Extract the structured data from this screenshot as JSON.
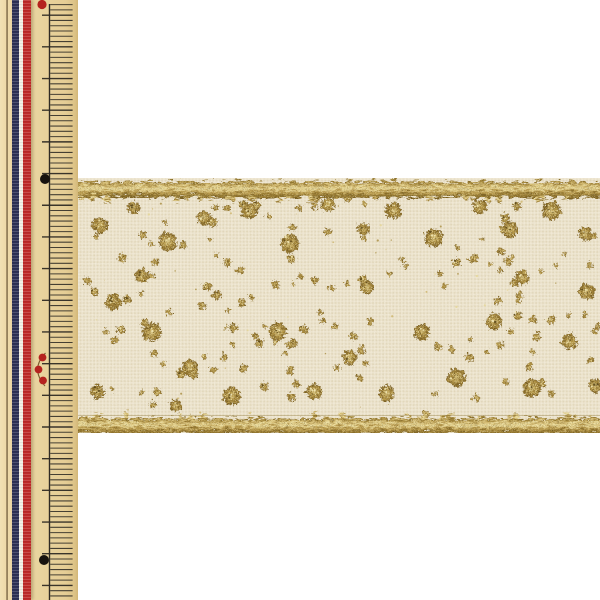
{
  "scene": {
    "description": "Product photo: ivory linen-texture ribbon with gold glitter dot pattern and gold tinsel edges, laid horizontally beside a vertical cream Japanese measuring ruler with a navy/white/red striped trim on its left edge",
    "background": "#ffffff"
  },
  "ruler": {
    "width": 78,
    "body_color": "#e9d5a0",
    "tick_color": "#2f2b24",
    "spine_x": 49.5,
    "spine_top": 4,
    "first_tick_y": 4.6,
    "minor_spacing": 5.28,
    "minors_per_major": 6,
    "major_phase": 2,
    "minor_x1": 50.2,
    "minor_x2": 72.6,
    "major_x1": 42,
    "major_x2": 72.6,
    "markers": {
      "red_dot_top": {
        "x": 42,
        "y": 4.5,
        "r": 4.6,
        "color": "#b5231f"
      },
      "black_dot_upper": {
        "x": 45,
        "y": 179,
        "r": 5,
        "color": "#17130f"
      },
      "black_dot_lower": {
        "x": 44,
        "y": 560,
        "r": 5,
        "color": "#17130f"
      },
      "red_cluster": {
        "color": "#b5231f",
        "r": 3.9,
        "dots": [
          [
            42.5,
            357.5
          ],
          [
            38.5,
            369.5
          ],
          [
            43,
            380.5
          ]
        ],
        "bracket_path": "M 45.5 353 Q 30 369 45 386",
        "bracket_color": "#7c5c30"
      }
    }
  },
  "tricolor": {
    "stripes": [
      {
        "name": "navy",
        "width": 7,
        "color": "#2c3156"
      },
      {
        "name": "white",
        "width": 4,
        "color": "#f3efe3"
      },
      {
        "name": "red",
        "width": 8,
        "color": "#bf2b28"
      }
    ]
  },
  "ribbon": {
    "x": 78,
    "y": 178,
    "width": 522,
    "height": 255,
    "fabric_base": "#efe6d2",
    "weave_light": "#f8f2e1",
    "weave_mid": "#f1ead6",
    "weave_dark": "#e3d8ba",
    "grain_color": [
      0.55,
      0.47,
      0.3
    ],
    "trim_height": 15.5,
    "trim_gradient": [
      "#8d7129",
      "#cdb268",
      "#eee1a4",
      "#c5a85c",
      "#9a7c33",
      "#7c6223"
    ],
    "trim_seam_color": "#8a7030",
    "dot_gold_center": "#dcca8a",
    "dot_gold_mid": "#b3964a",
    "dot_gold_edge": "#7b6126",
    "sparkle_light": "#f1e6b4",
    "sparkle_dark": "#5e4a1b"
  },
  "pattern": {
    "seed": 20231215,
    "big_dots": [
      [
        20,
        46,
        8
      ],
      [
        54,
        28,
        6
      ],
      [
        88,
        62,
        9
      ],
      [
        124,
        38,
        7
      ],
      [
        170,
        31,
        8
      ],
      [
        210,
        64,
        9
      ],
      [
        248,
        25,
        7
      ],
      [
        284,
        49,
        6
      ],
      [
        314,
        31,
        8
      ],
      [
        354,
        58,
        9
      ],
      [
        400,
        27,
        7
      ],
      [
        430,
        50,
        8
      ],
      [
        472,
        31,
        9
      ],
      [
        506,
        54,
        7
      ],
      [
        34,
        122,
        8
      ],
      [
        62,
        96,
        7
      ],
      [
        72,
        152,
        9
      ],
      [
        110,
        188,
        8
      ],
      [
        152,
        216,
        9
      ],
      [
        198,
        152,
        9
      ],
      [
        234,
        212,
        8
      ],
      [
        270,
        178,
        7
      ],
      [
        307,
        214,
        8
      ],
      [
        342,
        152,
        8
      ],
      [
        377,
        198,
        9
      ],
      [
        414,
        142,
        8
      ],
      [
        452,
        208,
        9
      ],
      [
        490,
        162,
        8
      ],
      [
        516,
        206,
        7
      ],
      [
        18,
        212,
        7
      ],
      [
        96,
        226,
        6
      ],
      [
        287,
        107,
        7
      ],
      [
        507,
        112,
        8
      ],
      [
        442,
        98,
        7
      ]
    ],
    "arcs": [
      {
        "cx": 110,
        "cy": 150,
        "r": 45,
        "a0": -70,
        "a1": 190,
        "n": 13
      },
      {
        "cx": 255,
        "cy": 62,
        "r": 46,
        "a0": 50,
        "a1": 310,
        "n": 13
      },
      {
        "cx": 245,
        "cy": 182,
        "r": 38,
        "a0": 140,
        "a1": 390,
        "n": 11
      },
      {
        "cx": 392,
        "cy": 128,
        "r": 48,
        "a0": -130,
        "a1": 115,
        "n": 13
      },
      {
        "cx": 492,
        "cy": 178,
        "r": 42,
        "a0": 115,
        "a1": 335,
        "n": 10
      },
      {
        "cx": 38,
        "cy": 82,
        "r": 38,
        "a0": -50,
        "a1": 150,
        "n": 9
      },
      {
        "cx": 165,
        "cy": 58,
        "r": 33,
        "a0": 95,
        "a1": 320,
        "n": 9
      },
      {
        "cx": 455,
        "cy": 58,
        "r": 36,
        "a0": 25,
        "a1": 245,
        "n": 9
      }
    ],
    "arc_dot_r": [
      2.0,
      4.6
    ],
    "arc_jitter": 3,
    "scatter_count": 58,
    "scatter_r": [
      1.8,
      4.2
    ],
    "fleck_count": 46,
    "fleck_colors": [
      "#cdb46a",
      "#a88c3f",
      "#e5d696"
    ]
  }
}
